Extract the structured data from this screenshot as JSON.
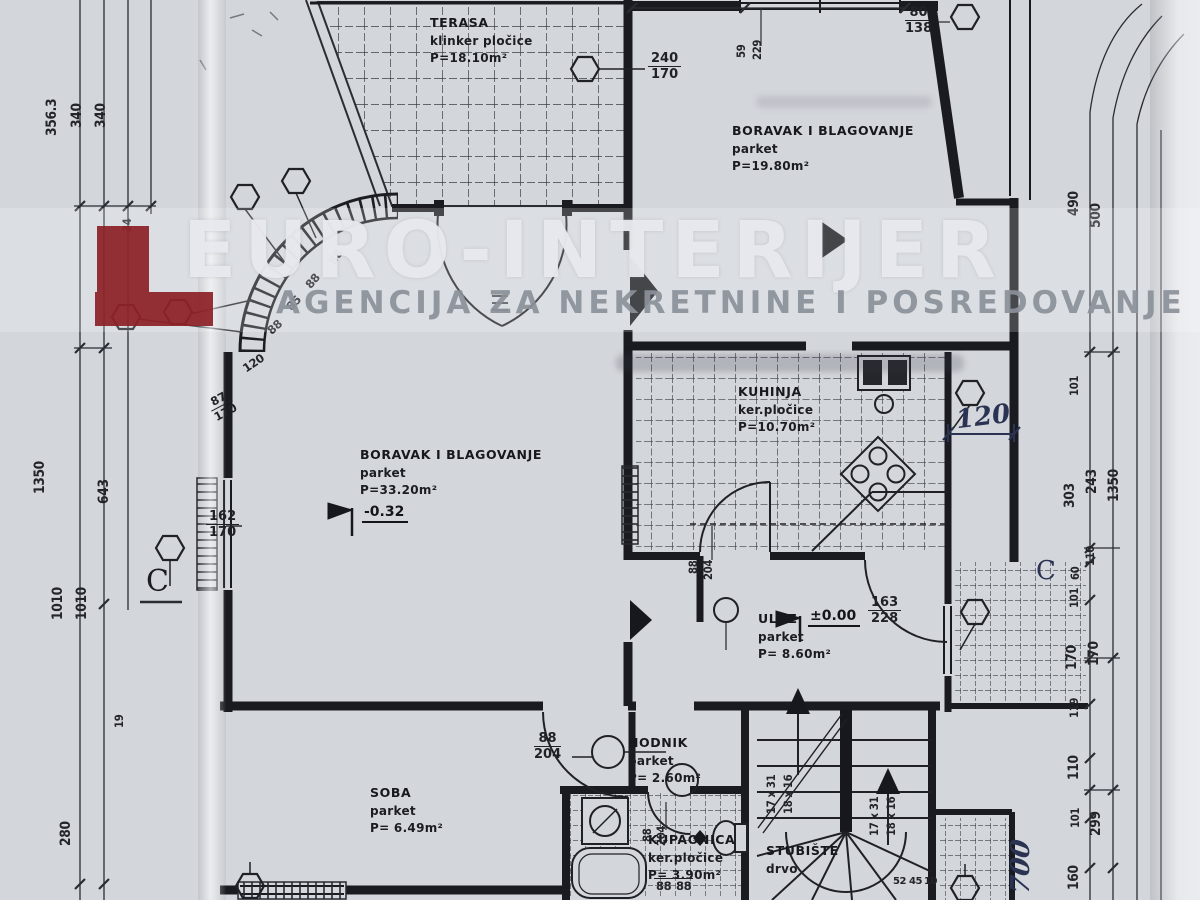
{
  "watermark": {
    "title": "EURO-INTERIJER",
    "subtitle": "AGENCIJA ZA NEKRETNINE I POSREDOVANJE",
    "accent_red": "#8c2025"
  },
  "rooms": {
    "terasa": {
      "name": "TERASA",
      "floor": "klinker pločice",
      "area": "P=18.10m²"
    },
    "boravak_gore": {
      "name": "BORAVAK I BLAGOVANJE",
      "floor": "parket",
      "area": "P=19.80m²"
    },
    "kuhinja": {
      "name": "KUHINJA",
      "floor": "ker.pločice",
      "area": "P=10.70m²"
    },
    "boravak": {
      "name": "BORAVAK I BLAGOVANJE",
      "floor": "parket",
      "area": "P=33.20m²",
      "level": "-0.32"
    },
    "ulaz": {
      "name": "ULAZ",
      "floor": "parket",
      "area": "P= 8.60m²",
      "level": "±0.00"
    },
    "hodnik": {
      "name": "HODNIK",
      "floor": "parket",
      "area": "P= 2.60m²"
    },
    "soba": {
      "name": "SOBA",
      "floor": "parket",
      "area": "P= 6.49m²"
    },
    "kupaonica": {
      "name": "KUPAONICA",
      "floor": "ker.pločice",
      "area": "P= 3.90m²"
    },
    "stubiste": {
      "name": "STUBIŠTE",
      "floor": "drvo"
    }
  },
  "dims": {
    "left": [
      "356.3",
      "340",
      "340",
      "34",
      "1350",
      "643",
      "1010",
      "1010",
      "19",
      "280"
    ],
    "right": [
      "490",
      "500",
      "101",
      "303",
      "243",
      "1350",
      "110",
      "60",
      "101",
      "170",
      "170",
      "119",
      "110",
      "101",
      "299",
      "160"
    ],
    "top_rot": {
      "num": "59",
      "den": "229"
    },
    "top_window": {
      "num": "80",
      "den": "138"
    },
    "terasa_door": {
      "num": "240",
      "den": "170"
    },
    "window_left": {
      "num": "162",
      "den": "170"
    },
    "ulaz_door": {
      "num": "163",
      "den": "228"
    },
    "hodnik_door": {
      "num": "88",
      "den": "204"
    },
    "kuhinja_door": {
      "num": "88",
      "den": "204"
    },
    "kupaonica_door": {
      "num": "88",
      "den": "204"
    },
    "arc": [
      "88",
      "88",
      "85",
      "88",
      "120"
    ],
    "arc_fraction": {
      "num": "87",
      "den": "170"
    },
    "bath_small": [
      "88",
      "88"
    ],
    "stairs_small": [
      "52",
      "45",
      "10"
    ],
    "handwritten_kitchen": "120",
    "handwritten_right": "700"
  },
  "stairs_labels": {
    "a": "17 x 31",
    "b": "18 x 16"
  },
  "sections": {
    "left": "C",
    "right": "C"
  }
}
